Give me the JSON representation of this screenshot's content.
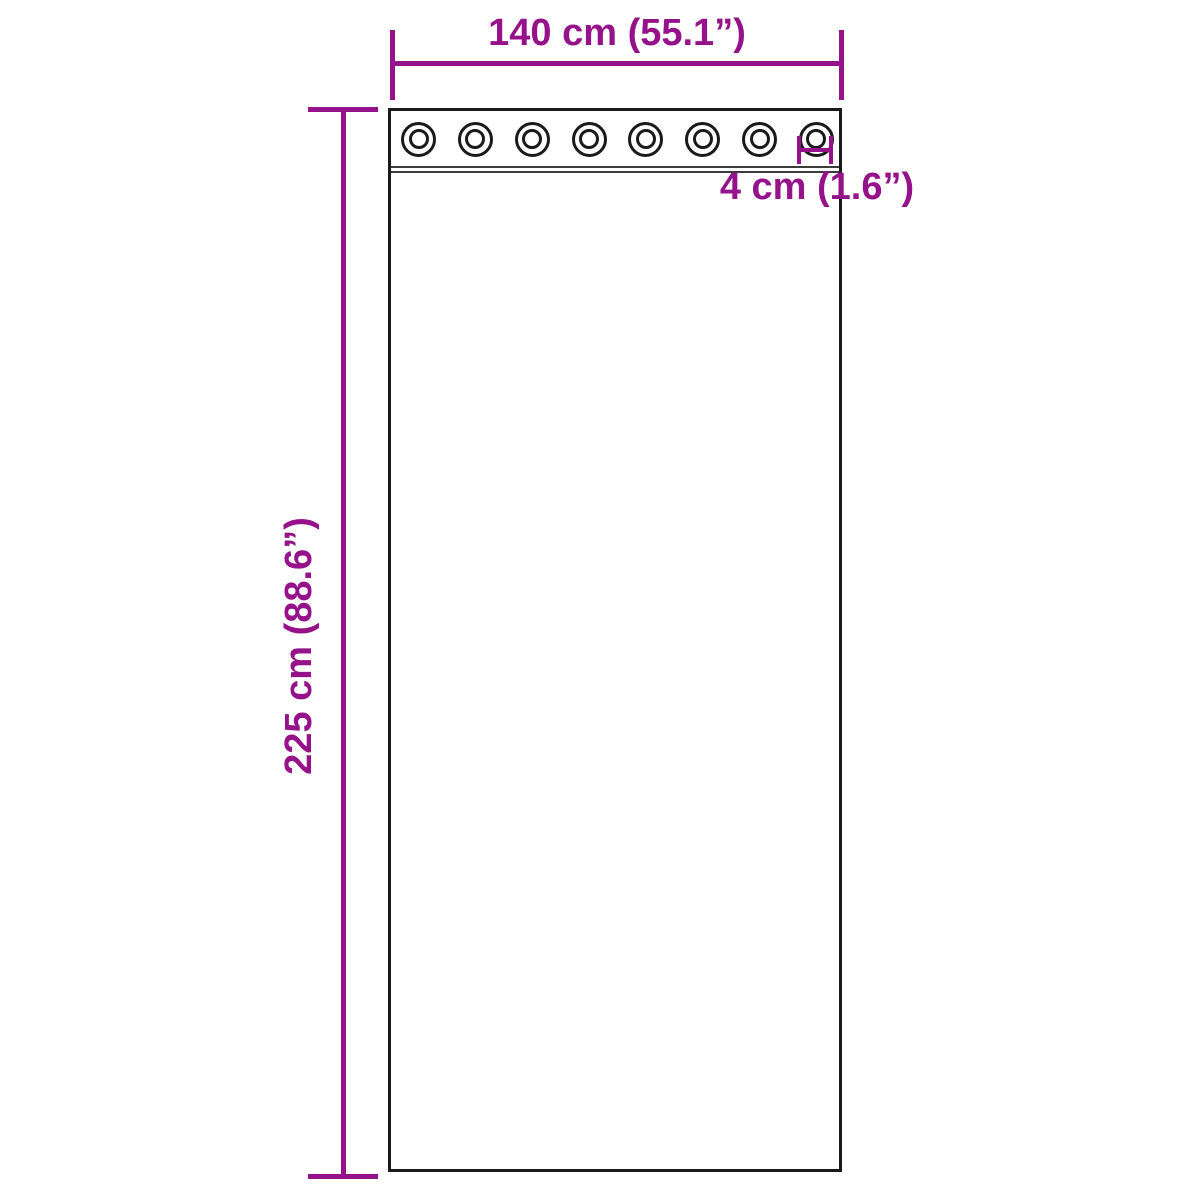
{
  "labels": {
    "width": "140 cm (55.1”)",
    "height": "225 cm (88.6”)",
    "grommet": "4 cm (1.6”)"
  },
  "grommets": {
    "count": 8
  },
  "colors": {
    "dimension": "#96128B",
    "outline": "#1A1A1A",
    "seam": "#3C3C3C",
    "background": "#FFFFFF"
  }
}
